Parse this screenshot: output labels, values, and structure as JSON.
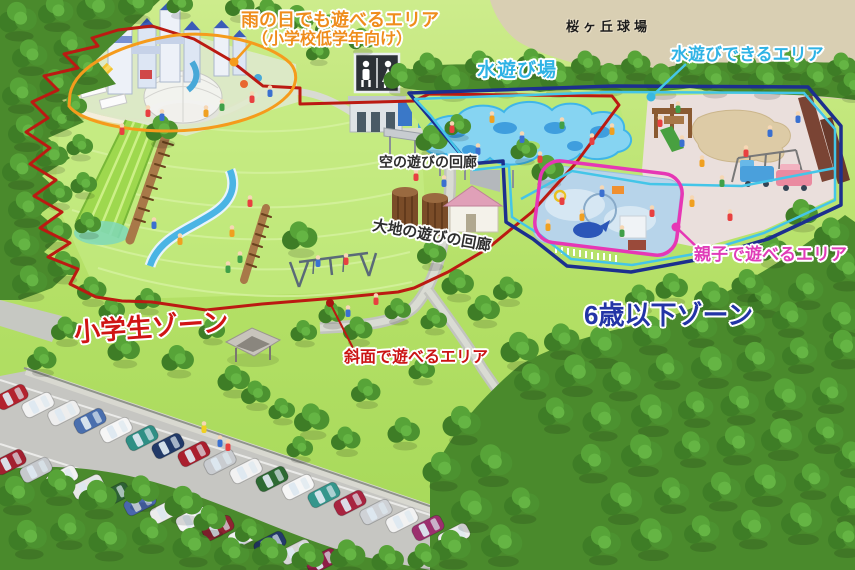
{
  "map": {
    "labels": {
      "rainy_area_line1": "雨の日でも遊べるエリア",
      "rainy_area_line2": "（小学校低学年向け）",
      "ballpark": "桜ヶ丘球場",
      "water_playground": "水遊び場",
      "water_play_area": "水遊びできるエリア",
      "sky_play_corridor": "空の遊びの回廊",
      "earth_play_corridor": "大地の遊びの回廊",
      "parent_child_area": "親子で遊べるエリア",
      "elementary_zone": "小学生ゾーン",
      "under_six_zone": "6歳以下ゾーン",
      "slope_play_area": "斜面で遊べるエリア"
    },
    "outline_colors": {
      "elementary_zone": "#bb1a12",
      "rainy_area": "#f59b1c",
      "under_six_zone": "#1c2f8e",
      "water_area": "#44c5e8",
      "parent_child_area": "#e637b5"
    },
    "icons": {
      "restroom": "🚻"
    }
  }
}
